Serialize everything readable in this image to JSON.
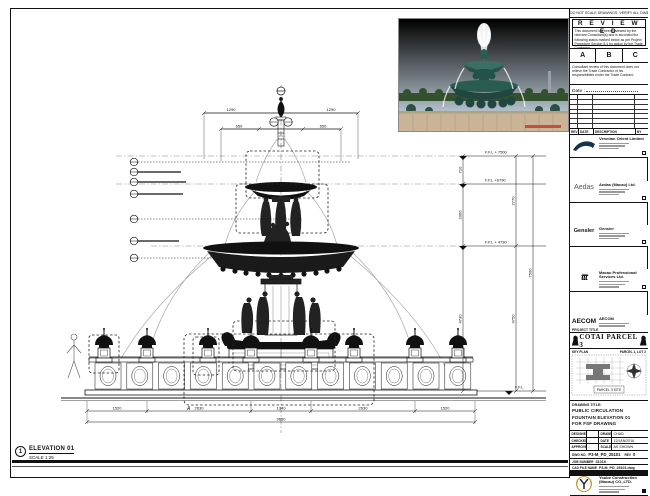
{
  "palette": {
    "line": "#1a1a1a",
    "water": "#a8a8a8",
    "sky": "#6ea7d6",
    "fountain_bronze": "#24524a",
    "stone": "#c9b497",
    "stamp_red": "#c0392b"
  },
  "sheet": {
    "top_note": "DO NOT SCALE DRAWINGS. VERIFY ALL DIMENSIONS ON SITE."
  },
  "stamp": {
    "title": "R E V I E W E D",
    "body": "This document has been reviewed by the relevant Consultant(s) and is accorded the following status marked below as per Project Procedure Section 5.4 for action by the Trade Contractor.",
    "status_a": "A",
    "status_b": "B",
    "status_c": "C",
    "note": "Consultant review of this document does not relieve the Trade Contractor of his responsibilities under the Trade Contract.",
    "date_label": "Date :"
  },
  "revision_table": {
    "headers": [
      "REV",
      "DATE",
      "DESCRIPTION",
      "BY"
    ]
  },
  "consultants": [
    {
      "logo": "venetian-swoosh",
      "name": "Venetian Orient Limited"
    },
    {
      "logo": "Aedas",
      "name": "Aedas (Macau) Ltd."
    },
    {
      "logo": "Gensler",
      "name": "Gensler"
    },
    {
      "logo": "ttt",
      "name": "Macau Professional Services Ltd."
    },
    {
      "logo": "AECOM",
      "name": "AECOM"
    },
    {
      "logo": "LangdonSeah",
      "name": "Langdon Seah"
    }
  ],
  "contractor": {
    "name": "Yoube Construction (Macau) CO.,LTD."
  },
  "project": {
    "label": "PROJECT TITLE",
    "title": "COTAI PARCEL 3"
  },
  "key_plan": {
    "label": "KEY PLAN",
    "top_right": "PARCEL 1, LOT 2",
    "bottom": "PARCEL 3 SITE"
  },
  "drawing_title": {
    "label": "DRAWING TITLE:",
    "line1": "PUBLIC CIRCULATION",
    "line2": "FOUNTAIN ELEVATION 01",
    "line3": "FOR FSF DRAWING"
  },
  "credits": {
    "designed_label": "DESIGNED",
    "designed": "",
    "drawn_label": "DRAWN",
    "drawn": "CHAD",
    "checked_label": "CHECKED",
    "checked": "-",
    "date_label": "DATE",
    "date": "12/JAN/2016",
    "approved_label": "APPROVED",
    "approved": "-",
    "scale_label": "SCALE",
    "scale": "AS SHOWN"
  },
  "refs": {
    "dwg_label": "DWG NO.",
    "dwg_no": "P3-M_PD_25101",
    "rev_label": "REV",
    "rev": "0",
    "job_label": "JOB NUMBER",
    "job": "31010",
    "cad_label": "CAD FILE NAME",
    "cad": "P3-M_PD_25101.dwg"
  },
  "drawing": {
    "bubble": "1",
    "name": "ELEVATION 01",
    "scale": "SCALE 1:25",
    "detail": "A",
    "levels": {
      "l1": "F.F.L + 7500",
      "l2": "F.F.L +6790",
      "l3": "F.F.L + 4730",
      "l4": "F.F.L."
    },
    "dims": {
      "top1": "1290",
      "top2": "1290",
      "u1": "650",
      "u2": "650",
      "b1": "1520",
      "b2": "2630",
      "b3": "1340",
      "b4": "2630",
      "b5": "1520",
      "total": "9650",
      "v1": "710",
      "v2": "2060",
      "v3": "4730",
      "v4": "2770",
      "v5": "4750",
      "v6": "7500"
    }
  }
}
